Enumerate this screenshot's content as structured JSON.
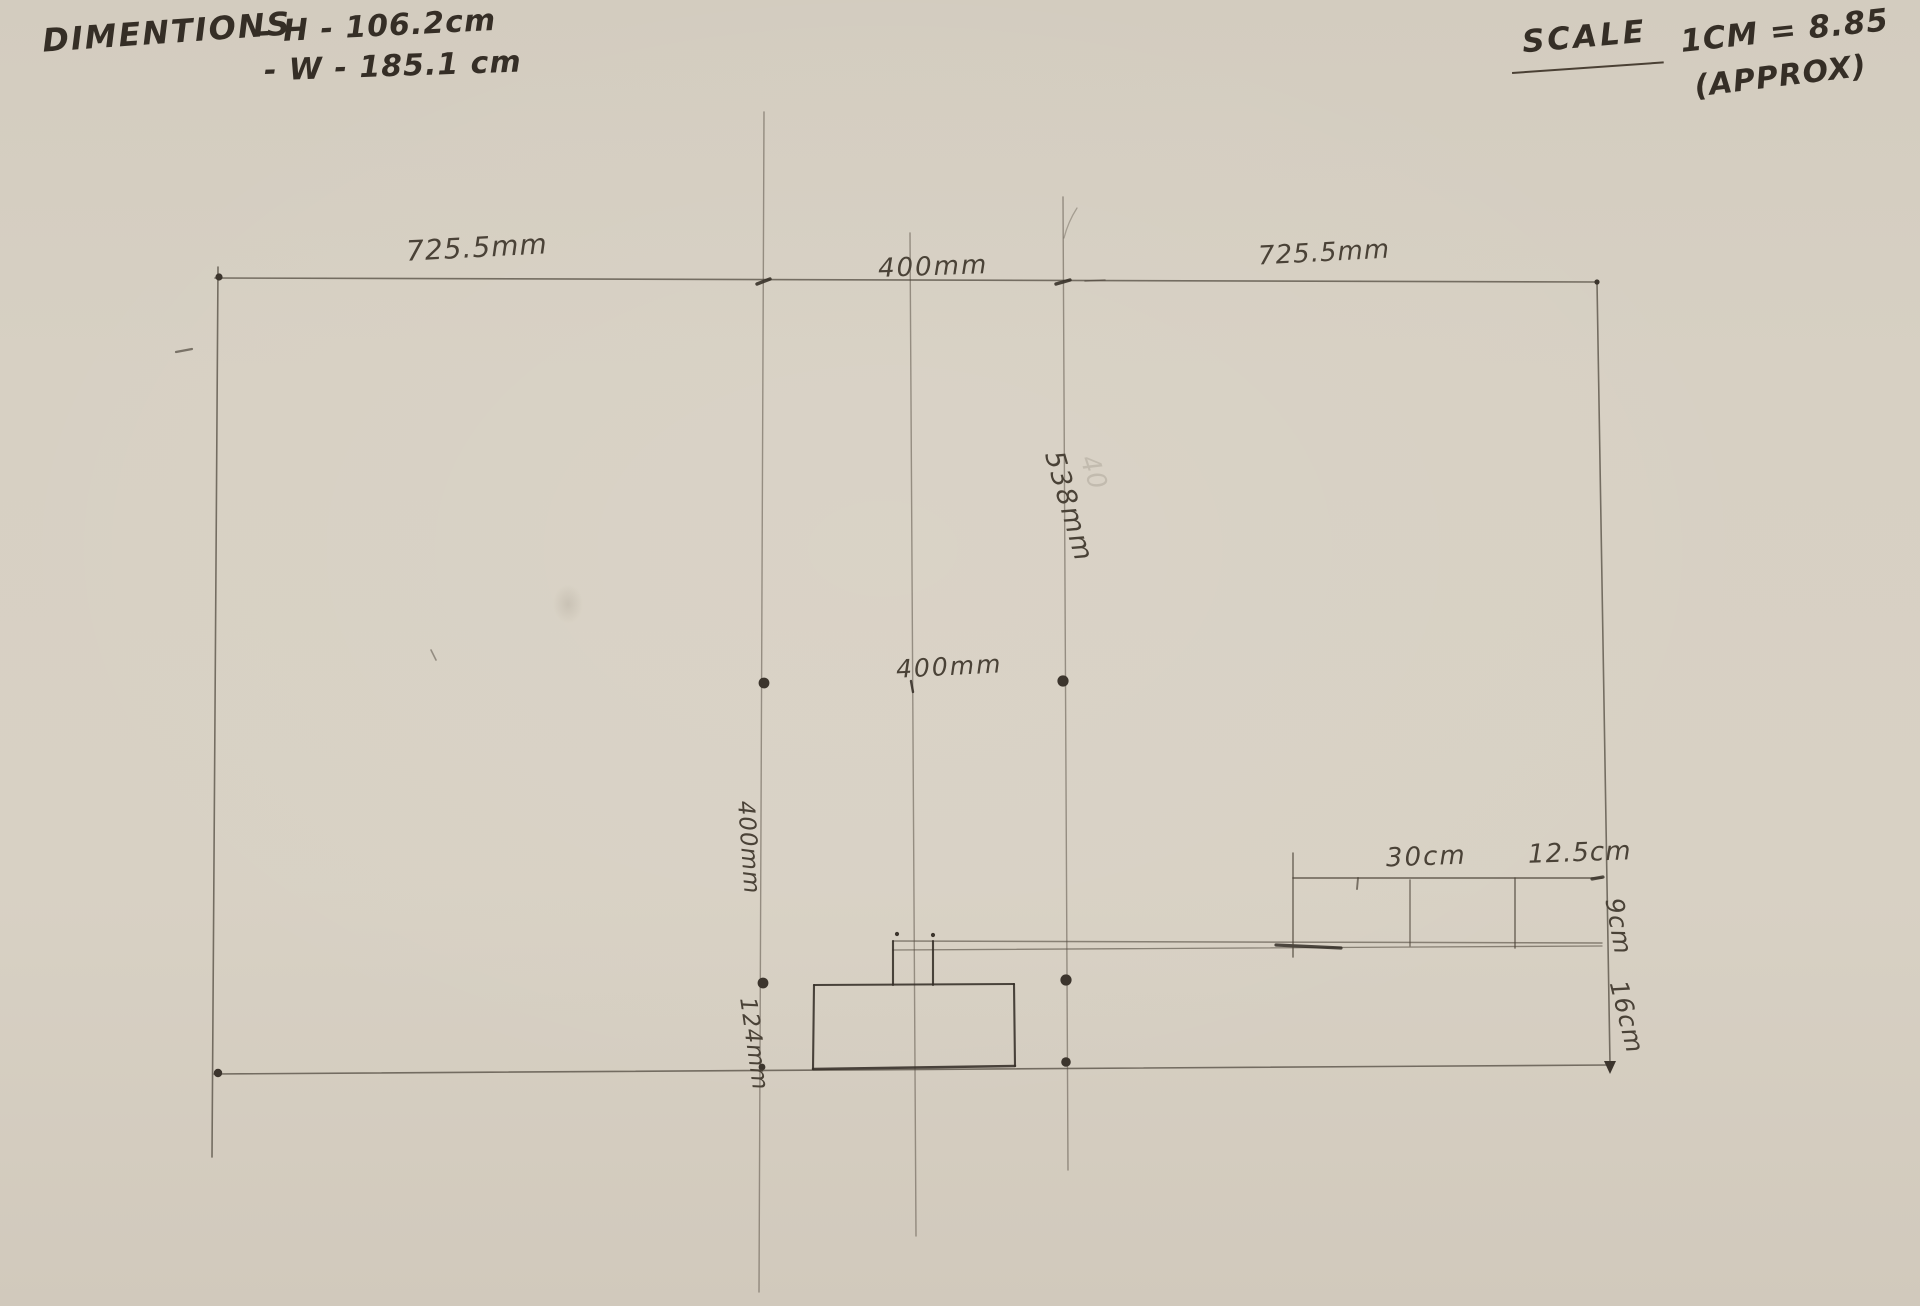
{
  "header": {
    "dimensions_label": "DIMENTIONS",
    "height_note": "- H - 106.2cm",
    "width_note": "- W - 185.1 cm",
    "scale_label": "SCALE",
    "scale_value": "1CM = 8.85",
    "scale_qualifier": "(APPROX)"
  },
  "drawing": {
    "top_dims": [
      "725.5mm",
      "400mm",
      "725.5mm"
    ],
    "vertical_dim": "538mm",
    "mid_dim": "400mm",
    "left_vertical_dims": [
      "400mm",
      "124mm"
    ],
    "right_dims": {
      "top": [
        "30cm",
        "12.5cm"
      ],
      "side": [
        "9cm",
        "16cm"
      ]
    },
    "ghost_mark": "40"
  },
  "diagram_data": {
    "type": "hand-drawn dimensioned sketch",
    "overall_height": "106.2cm",
    "overall_width": "185.1 cm",
    "scale": "1CM = 8.85 (APPROX)",
    "top_width_segments_mm": [
      725.5,
      400,
      725.5
    ],
    "height_segments_mm": [
      538,
      400,
      124
    ],
    "detail_horizontal_cm": [
      30,
      12.5
    ],
    "detail_vertical_cm": [
      9,
      16
    ],
    "colors": {
      "paper": "#d6cfc2",
      "pencil_light": "#5c544a",
      "pencil_dark": "#3a332b"
    }
  }
}
